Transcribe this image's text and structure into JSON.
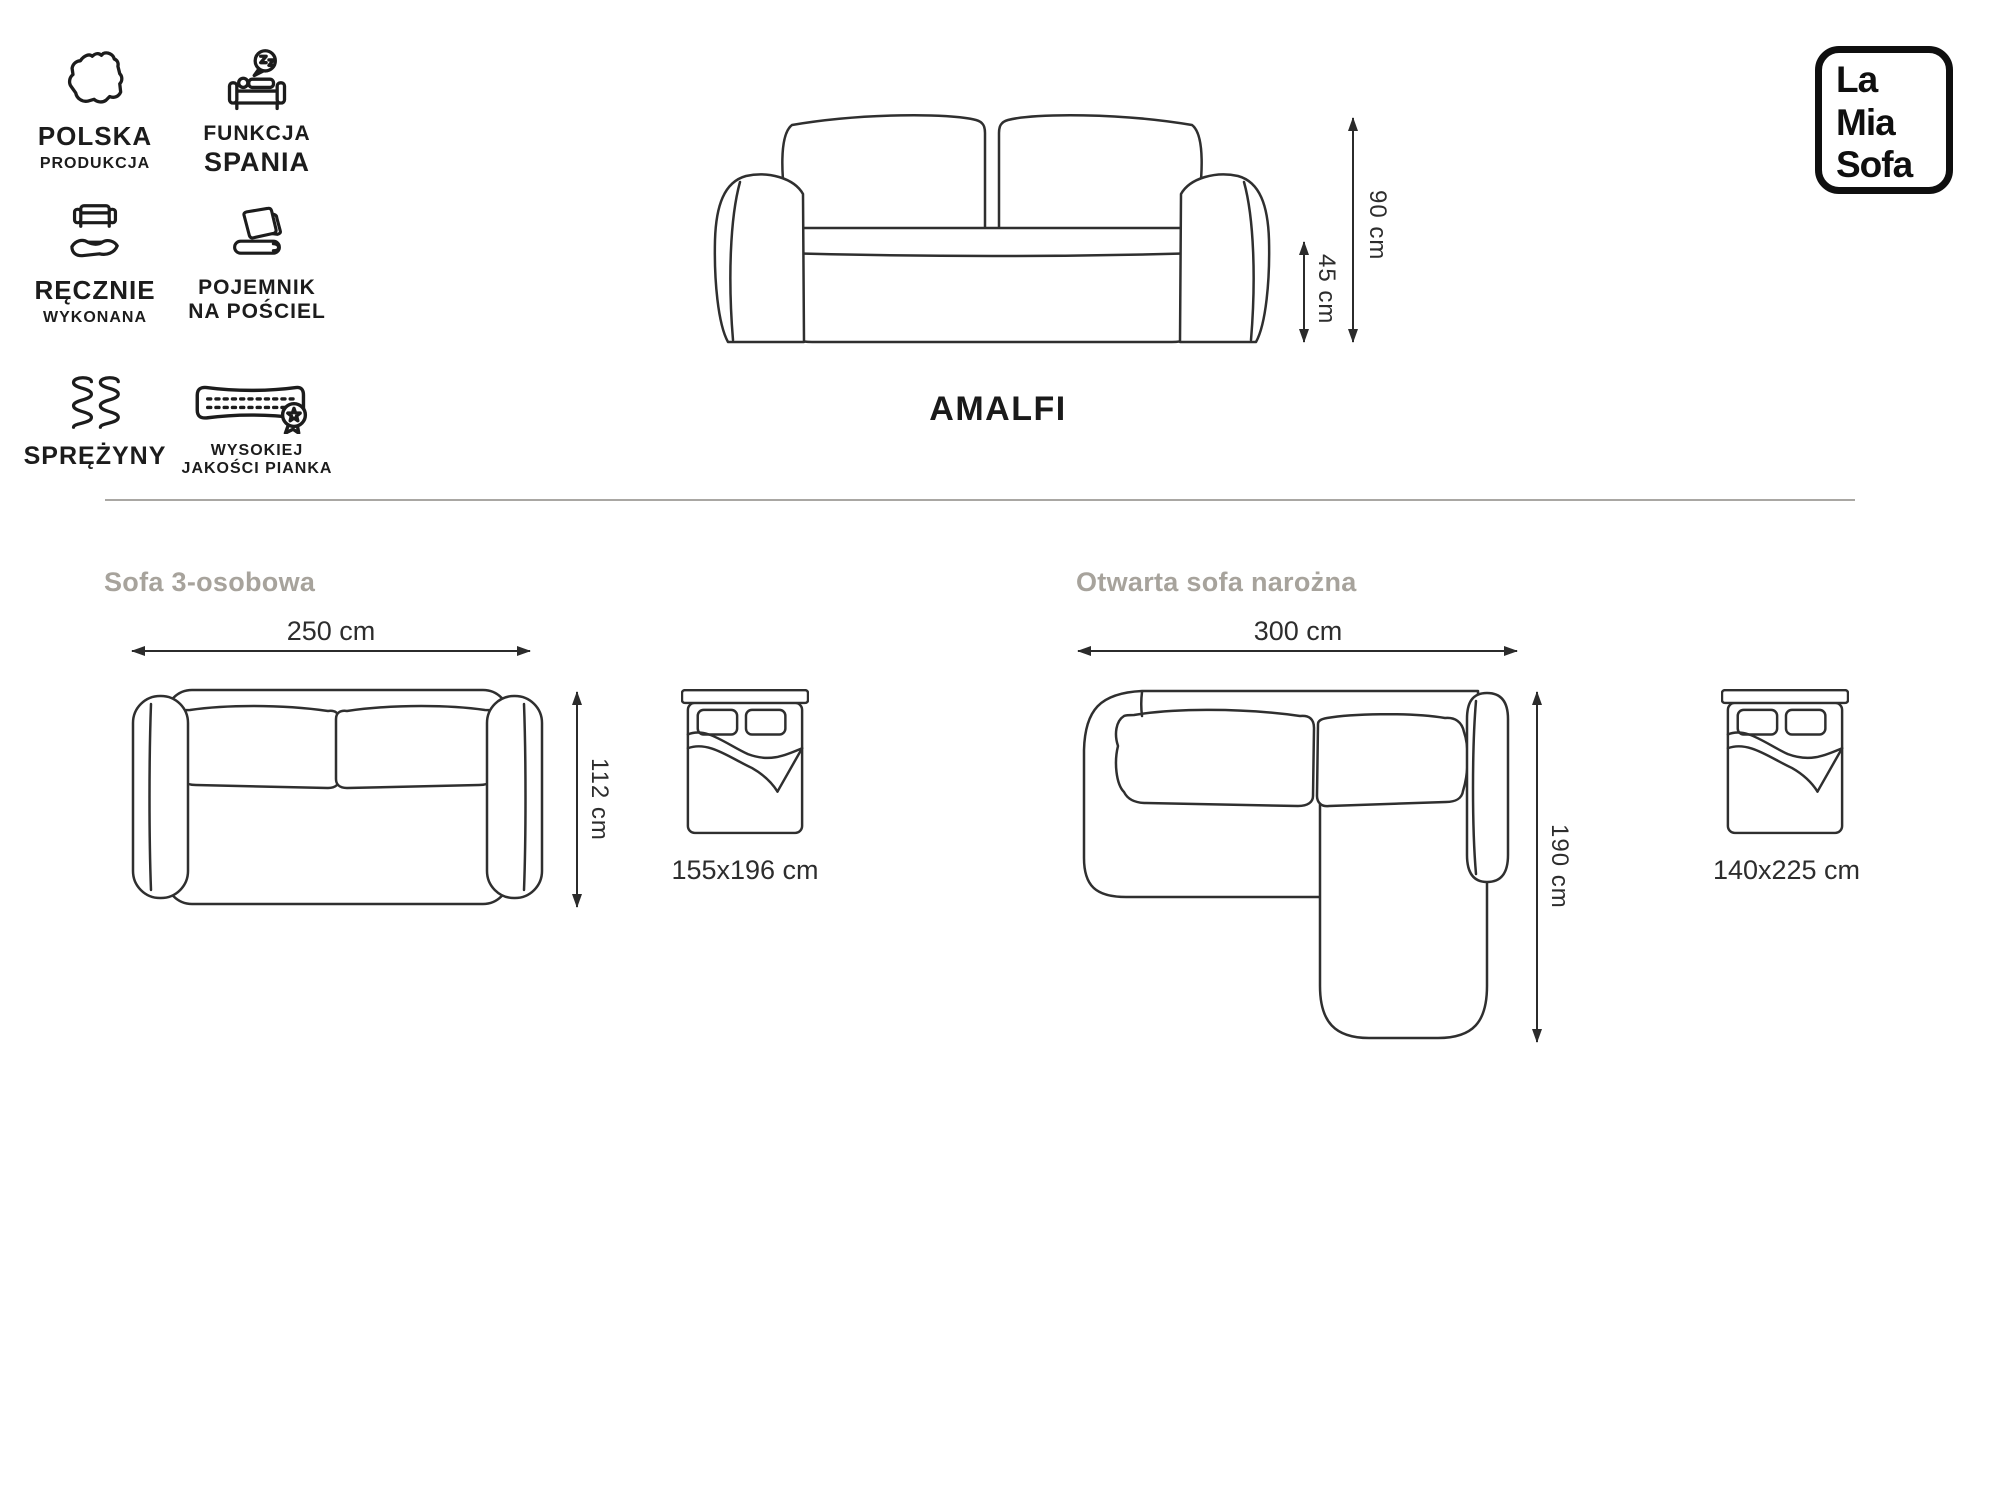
{
  "brand": {
    "lines": [
      "La",
      "Mia",
      "Sofa"
    ]
  },
  "product": {
    "name": "AMALFI"
  },
  "features": [
    {
      "id": "polska-produkcja",
      "label_primary": "POLSKA",
      "label_secondary": "PRODUKCJA"
    },
    {
      "id": "funkcja-spania",
      "label_primary": "FUNKCJA",
      "label_secondary": "SPANIA"
    },
    {
      "id": "recznie-wykonana",
      "label_primary": "RĘCZNIE",
      "label_secondary": "WYKONANA"
    },
    {
      "id": "pojemnik-na-posciel",
      "label_primary": "POJEMNIK",
      "label_secondary": "NA POŚCIEL"
    },
    {
      "id": "sprezyny",
      "label_primary": "SPRĘŻYNY",
      "label_secondary": ""
    },
    {
      "id": "wysokiej-jakosci-pianka",
      "label_primary": "WYSOKIEJ",
      "label_secondary": "JAKOŚCI PIANKA"
    }
  ],
  "front_view": {
    "total_height": "90 cm",
    "seat_height": "45 cm"
  },
  "variants": [
    {
      "title": "Sofa 3-osobowa",
      "width": "250 cm",
      "depth": "112 cm",
      "bed": "155x196 cm"
    },
    {
      "title": "Otwarta sofa narożna",
      "width": "300 cm",
      "depth": "190 cm",
      "bed": "140x225 cm"
    }
  ],
  "colors": {
    "line": "#2f2f2f",
    "ink": "#1c1c1c",
    "muted_heading": "#a7a39c"
  }
}
